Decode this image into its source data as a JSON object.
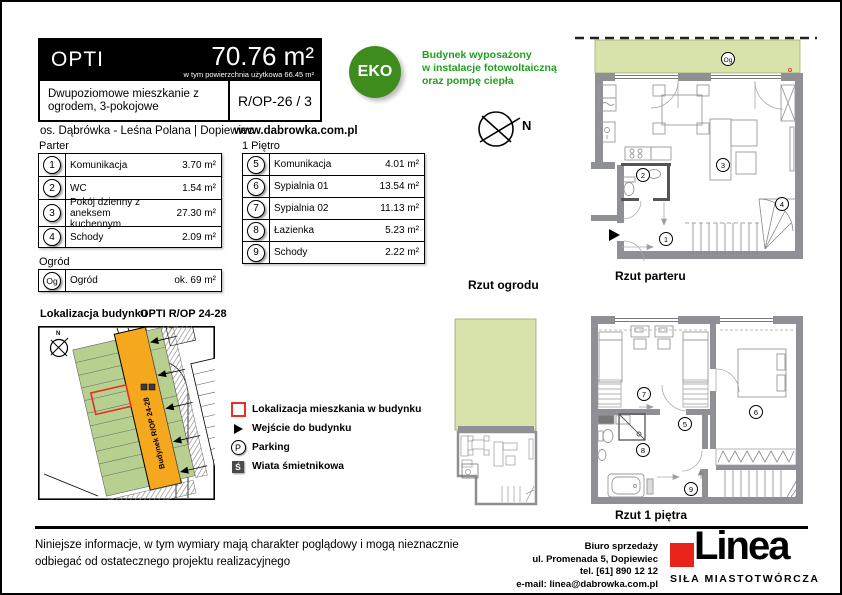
{
  "header": {
    "name": "OPTI",
    "area": "70.76 m²",
    "area_note": "w tym powierzchnia użytkowa 66.45 m²",
    "description": "Dwupoziomowe mieszkanie z ogrodem, 3-pokojowe",
    "unit_code": "R/OP-26 / 3",
    "location": "os. Dąbrówka - Leśna Polana | Dopiewiec",
    "website": "www.dabrowka.com.pl"
  },
  "eco": {
    "badge_label": "EKO",
    "line1": "Budynek wyposażony",
    "line2": "w instalacje fotowoltaiczną",
    "line3": "oraz pompę ciepła"
  },
  "compass": {
    "north_label": "N"
  },
  "rooms": {
    "parter": {
      "title": "Parter",
      "rows": [
        {
          "no": "1",
          "name": "Komunikacja",
          "area": "3.70 m²"
        },
        {
          "no": "2",
          "name": "WC",
          "area": "1.54 m²"
        },
        {
          "no": "3",
          "name": "Pokój dzienny z aneksem kuchennym",
          "area": "27.30 m²"
        },
        {
          "no": "4",
          "name": "Schody",
          "area": "2.09 m²"
        }
      ]
    },
    "pietro": {
      "title": "1 Piętro",
      "rows": [
        {
          "no": "5",
          "name": "Komunikacja",
          "area": "4.01 m²"
        },
        {
          "no": "6",
          "name": "Sypialnia 01",
          "area": "13.54 m²"
        },
        {
          "no": "7",
          "name": "Sypialnia 02",
          "area": "11.13 m²"
        },
        {
          "no": "8",
          "name": "Łazienka",
          "area": "5.23 m²"
        },
        {
          "no": "9",
          "name": "Schody",
          "area": "2.22 m²"
        }
      ]
    },
    "ogrod": {
      "title": "Ogród",
      "rows": [
        {
          "no": "Og",
          "name": "Ogród",
          "area": "ok. 69 m²"
        }
      ]
    }
  },
  "site_map": {
    "title": "Lokalizacja budynku",
    "building_code": "OPTI R/OP 24-28",
    "building_label": "Budynek R/OP 24-28",
    "legend": [
      {
        "icon": "apartment-location-red-square",
        "label": "Lokalizacja mieszkania w budynku"
      },
      {
        "icon": "entrance-arrow",
        "label": "Wejście do budynku"
      },
      {
        "icon": "parking-circle",
        "icon_text": "P",
        "label": "Parking"
      },
      {
        "icon": "bin-shelter-square",
        "icon_text": "Ś",
        "label": "Wiata śmietnikowa"
      }
    ]
  },
  "plans": {
    "garden_caption": "Rzut ogrodu",
    "ground_caption": "Rzut parteru",
    "first_caption": "Rzut 1 piętra",
    "labels": {
      "og": "Og",
      "n1": "1",
      "n2": "2",
      "n3": "3",
      "n4": "4",
      "n5": "5",
      "n6": "6",
      "n7": "7",
      "n8": "8",
      "n9": "9"
    }
  },
  "footer": {
    "disclaimer_line1": "Niniejsze informacje, w tym wymiary mają charakter poglądowy i mogą nieznacznie",
    "disclaimer_line2": "odbiegać od ostatecznego projektu realizacyjnego",
    "office_line1": "Biuro sprzedaży",
    "office_line2": "ul. Promenada 5, Dopiewiec",
    "office_line3": "tel. [61] 890 12 12",
    "office_line4": "e-mail: linea@dabrowka.com.pl",
    "logo_text": "Linea",
    "logo_tagline": "SIŁA MIASTOTWÓRCZA"
  },
  "colors": {
    "eco_green": "#3f8c1e",
    "text_green": "#1fa11f",
    "plan_garden_green": "#d8e2ab",
    "map_garden_green": "#b7d08f",
    "building_orange": "#f5a81e",
    "marker_red": "#e53022",
    "wall_gray": "#8f8f96",
    "logo_red": "#e8231a"
  }
}
